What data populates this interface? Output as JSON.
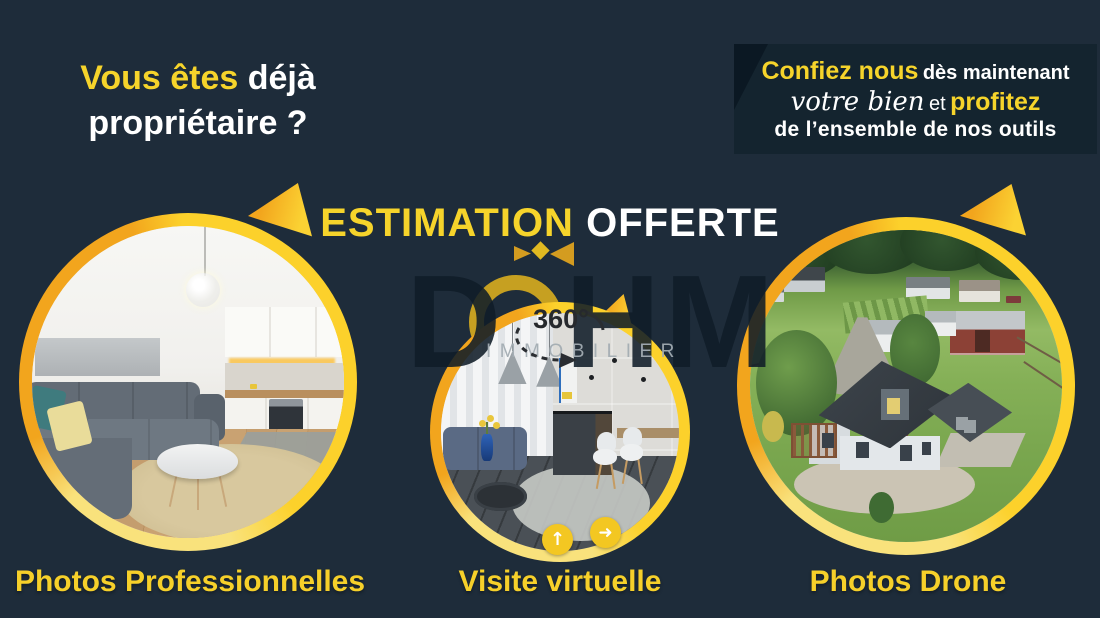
{
  "headline": {
    "line1_accent": "Vous êtes",
    "line1_rest": "déjà",
    "line2": "propriétaire ?"
  },
  "offer_box": {
    "line1_accent": "Confiez nous",
    "line1_rest": "dès maintenant",
    "line2_script": "votre bien",
    "line2_mid": "et",
    "line2_accent": "profitez",
    "line3": "de l’ensemble de nos outils"
  },
  "estimation": {
    "accent": "ESTIMATION",
    "rest": "OFFERTE"
  },
  "watermark": {
    "brand": "DOHM",
    "letter_d": "D",
    "letters_hm": "HM",
    "subtitle": "IMMOBILIER"
  },
  "badge360": {
    "label": "360°"
  },
  "icons": {
    "arrow_up": "↑",
    "arrow_right": "➜"
  },
  "features": [
    {
      "id": "photos-professionnelles",
      "label": "Photos Professionnelles"
    },
    {
      "id": "visite-virtuelle",
      "label": "Visite virtuelle"
    },
    {
      "id": "photos-drone",
      "label": "Photos Drone"
    }
  ],
  "colors": {
    "background": "#1e2c3a",
    "offer_box_bg": "#14242f",
    "accent_yellow": "#f6d42b",
    "accent_amber": "#f2a51d",
    "pale_yellow": "#f9e27c",
    "white": "#ffffff"
  }
}
